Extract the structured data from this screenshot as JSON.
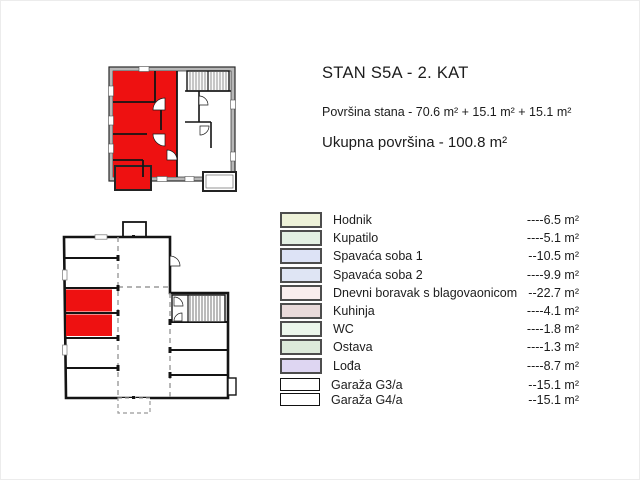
{
  "page": {
    "title": "STAN S5A - 2. KAT",
    "area_line": "Površina stana - 70.6 m² + 15.1 m² + 15.1 m²",
    "total_line": "Ukupna površina - 100.8 m²"
  },
  "colors": {
    "highlight_red": "#ee1111",
    "wall_gray": "#b8b8b8",
    "line_black": "#1a1a1a"
  },
  "plans": {
    "apartment": {
      "name": "apartment floor plan — 2. kat, stan S5A highlighted"
    },
    "garage": {
      "name": "garage level floor plan — stalls G3/a and G4/a highlighted"
    }
  },
  "legend": {
    "items": [
      {
        "label": "Hodnik",
        "value": "----6.5 m²",
        "swatch": "#eef2d9",
        "border": "gray"
      },
      {
        "label": "Kupatilo",
        "value": "----5.1 m²",
        "swatch": "#e3f0e3",
        "border": "gray"
      },
      {
        "label": "Spavaća soba 1",
        "value": "--10.5 m²",
        "swatch": "#dde3f6",
        "border": "gray"
      },
      {
        "label": "Spavaća soba 2",
        "value": "----9.9 m²",
        "swatch": "#dfe5f4",
        "border": "gray"
      },
      {
        "label": "Dnevni boravak s blagovaonicom",
        "value": "--22.7 m²",
        "swatch": "#f9eeee",
        "border": "gray"
      },
      {
        "label": "Kuhinja",
        "value": "----4.1 m²",
        "swatch": "#e9dada",
        "border": "gray"
      },
      {
        "label": "WC",
        "value": "----1.8 m²",
        "swatch": "#ebf6eb",
        "border": "gray"
      },
      {
        "label": "Ostava",
        "value": "----1.3 m²",
        "swatch": "#dceada",
        "border": "gray"
      },
      {
        "label": "Lođa",
        "value": "----8.7 m²",
        "swatch": "#ded6f2",
        "border": "gray"
      },
      {
        "label": "Garaža G3/a",
        "value": "--15.1 m²",
        "swatch": "#ffffff",
        "border": "black"
      },
      {
        "label": "Garaža G4/a",
        "value": "--15.1 m²",
        "swatch": "#ffffff",
        "border": "black"
      }
    ]
  }
}
